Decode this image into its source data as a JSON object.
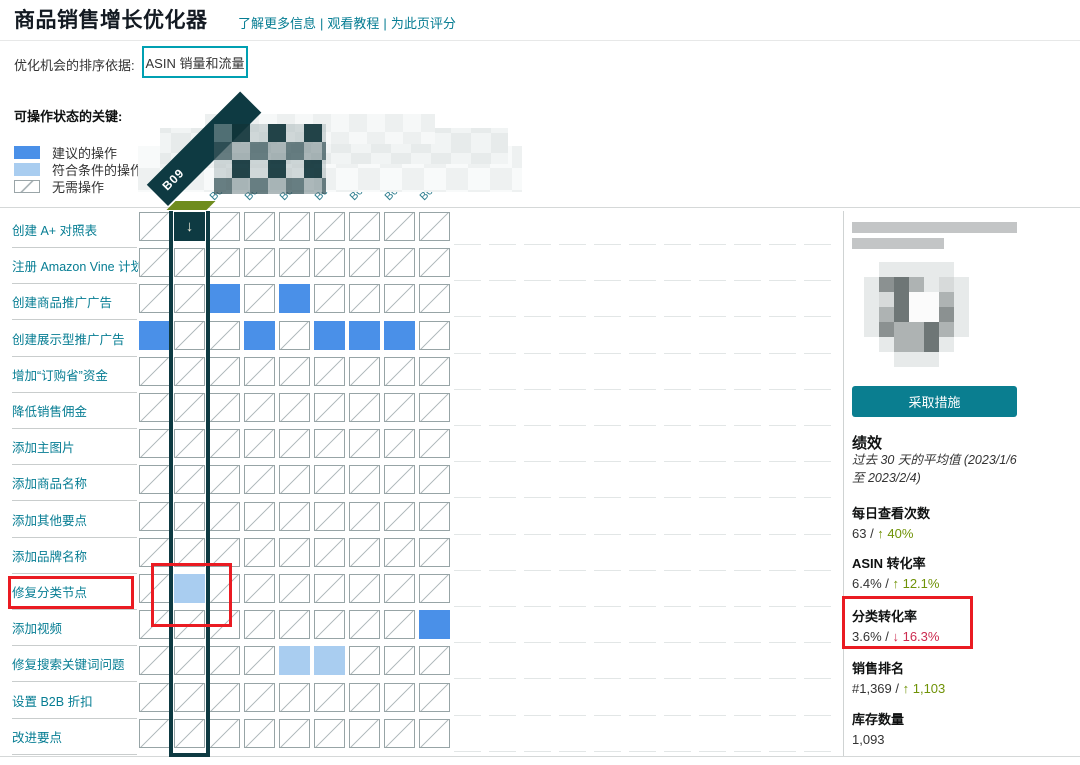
{
  "header": {
    "title": "商品销售增长优化器",
    "links": [
      "了解更多信息",
      "观看教程",
      "为此页评分"
    ]
  },
  "sort": {
    "label": "优化机会的排序依据:",
    "button_label": "ASIN 销量和流量"
  },
  "legend": {
    "title": "可操作状态的关键:",
    "items": [
      {
        "key": "rec",
        "label": "建议的操作"
      },
      {
        "key": "elig",
        "label": "符合条件的操作"
      },
      {
        "key": "none",
        "label": "无需操作"
      }
    ]
  },
  "table": {
    "selected_column": {
      "column_index": 1,
      "asin_fragment": "B09",
      "arrow_glyph": "↓"
    },
    "column_fragments": [
      "",
      "B09",
      "B08",
      "B0C",
      "B0L",
      "B0C",
      "B0L",
      "B0C",
      "B0C"
    ],
    "rows": [
      {
        "label": "创建 A+ 对照表",
        "cells": [
          "none",
          "arrow",
          "none",
          "none",
          "none",
          "none",
          "none",
          "none",
          "none"
        ]
      },
      {
        "label": "注册 Amazon Vine 计划",
        "cells": [
          "none",
          "none",
          "none",
          "none",
          "none",
          "none",
          "none",
          "none",
          "none"
        ]
      },
      {
        "label": "创建商品推广广告",
        "cells": [
          "none",
          "none",
          "rec",
          "none",
          "rec",
          "none",
          "none",
          "none",
          "none"
        ]
      },
      {
        "label": "创建展示型推广广告",
        "cells": [
          "rec",
          "none",
          "none",
          "rec",
          "none",
          "rec",
          "rec",
          "rec",
          "none"
        ]
      },
      {
        "label": "增加“订购省”资金",
        "cells": [
          "none",
          "none",
          "none",
          "none",
          "none",
          "none",
          "none",
          "none",
          "none"
        ]
      },
      {
        "label": "降低销售佣金",
        "cells": [
          "none",
          "none",
          "none",
          "none",
          "none",
          "none",
          "none",
          "none",
          "none"
        ]
      },
      {
        "label": "添加主图片",
        "cells": [
          "none",
          "none",
          "none",
          "none",
          "none",
          "none",
          "none",
          "none",
          "none"
        ]
      },
      {
        "label": "添加商品名称",
        "cells": [
          "none",
          "none",
          "none",
          "none",
          "none",
          "none",
          "none",
          "none",
          "none"
        ]
      },
      {
        "label": "添加其他要点",
        "cells": [
          "none",
          "none",
          "none",
          "none",
          "none",
          "none",
          "none",
          "none",
          "none"
        ]
      },
      {
        "label": "添加品牌名称",
        "cells": [
          "none",
          "none",
          "none",
          "none",
          "none",
          "none",
          "none",
          "none",
          "none"
        ]
      },
      {
        "label": "修复分类节点",
        "cells": [
          "none",
          "elig",
          "none",
          "none",
          "none",
          "none",
          "none",
          "none",
          "none"
        ],
        "highlighted": true
      },
      {
        "label": "添加视频",
        "cells": [
          "none",
          "none",
          "none",
          "none",
          "none",
          "none",
          "none",
          "none",
          "rec"
        ]
      },
      {
        "label": "修复搜索关键词问题",
        "cells": [
          "none",
          "none",
          "none",
          "none",
          "elig",
          "elig",
          "none",
          "none",
          "none"
        ]
      },
      {
        "label": "设置 B2B 折扣",
        "cells": [
          "none",
          "none",
          "none",
          "none",
          "none",
          "none",
          "none",
          "none",
          "none"
        ]
      },
      {
        "label": "改进要点",
        "cells": [
          "none",
          "none",
          "none",
          "none",
          "none",
          "none",
          "none",
          "none",
          "none"
        ]
      }
    ]
  },
  "panel": {
    "action_button": "采取措施",
    "performance": {
      "title": "绩效",
      "subtitle": "过去 30 天的平均值 (2023/1/6 至 2023/2/4)",
      "metrics": [
        {
          "label": "每日查看次数",
          "value": "63 /",
          "delta": "↑ 40%",
          "trend": "up",
          "highlighted": false
        },
        {
          "label": "ASIN 转化率",
          "value": "6.4% /",
          "delta": "↑ 12.1%",
          "trend": "up",
          "highlighted": false
        },
        {
          "label": "分类转化率",
          "value": "3.6% /",
          "delta": "↓ 16.3%",
          "trend": "down",
          "highlighted": true
        },
        {
          "label": "销售排名",
          "value": "#1,369 /",
          "delta": "↑ 1,103",
          "trend": "up",
          "highlighted": false
        },
        {
          "label": "库存数量",
          "value": "1,093",
          "delta": "",
          "trend": "none",
          "highlighted": false
        }
      ]
    }
  },
  "colors": {
    "teal_link": "#067d93",
    "teal_button": "#0a7e90",
    "teal_button_border": "#00a0b2",
    "recommended_blue": "#4a90e8",
    "eligible_blue": "#a9cdf0",
    "selected_column_dark": "#0e3a42",
    "olive_marker": "#6f8c1e",
    "positive_green": "#6f9206",
    "negative_red": "#cc2c50",
    "highlight_box_red": "#ea1b22"
  }
}
